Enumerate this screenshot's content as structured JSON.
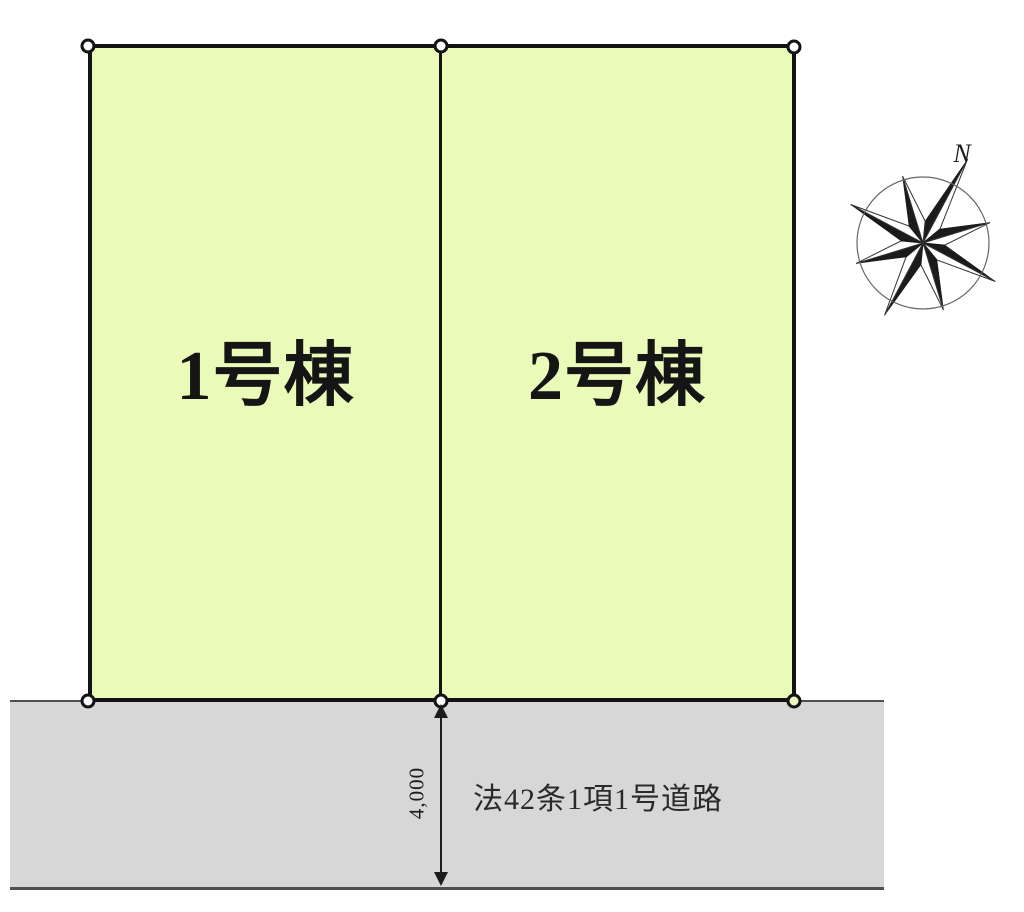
{
  "canvas": {
    "background": "#ffffff"
  },
  "plot": {
    "fill_color": "#eafab8",
    "outline_color": "#131313",
    "parcels": [
      {
        "label": "1号棟"
      },
      {
        "label": "2号棟"
      }
    ]
  },
  "road": {
    "label": "法42条1項1号道路",
    "fill_color": "#d7d7d7"
  },
  "dimension": {
    "value": "4,000"
  },
  "compass": {
    "label": "N"
  },
  "markers": {
    "special_fill_color": "#eef3bb"
  }
}
